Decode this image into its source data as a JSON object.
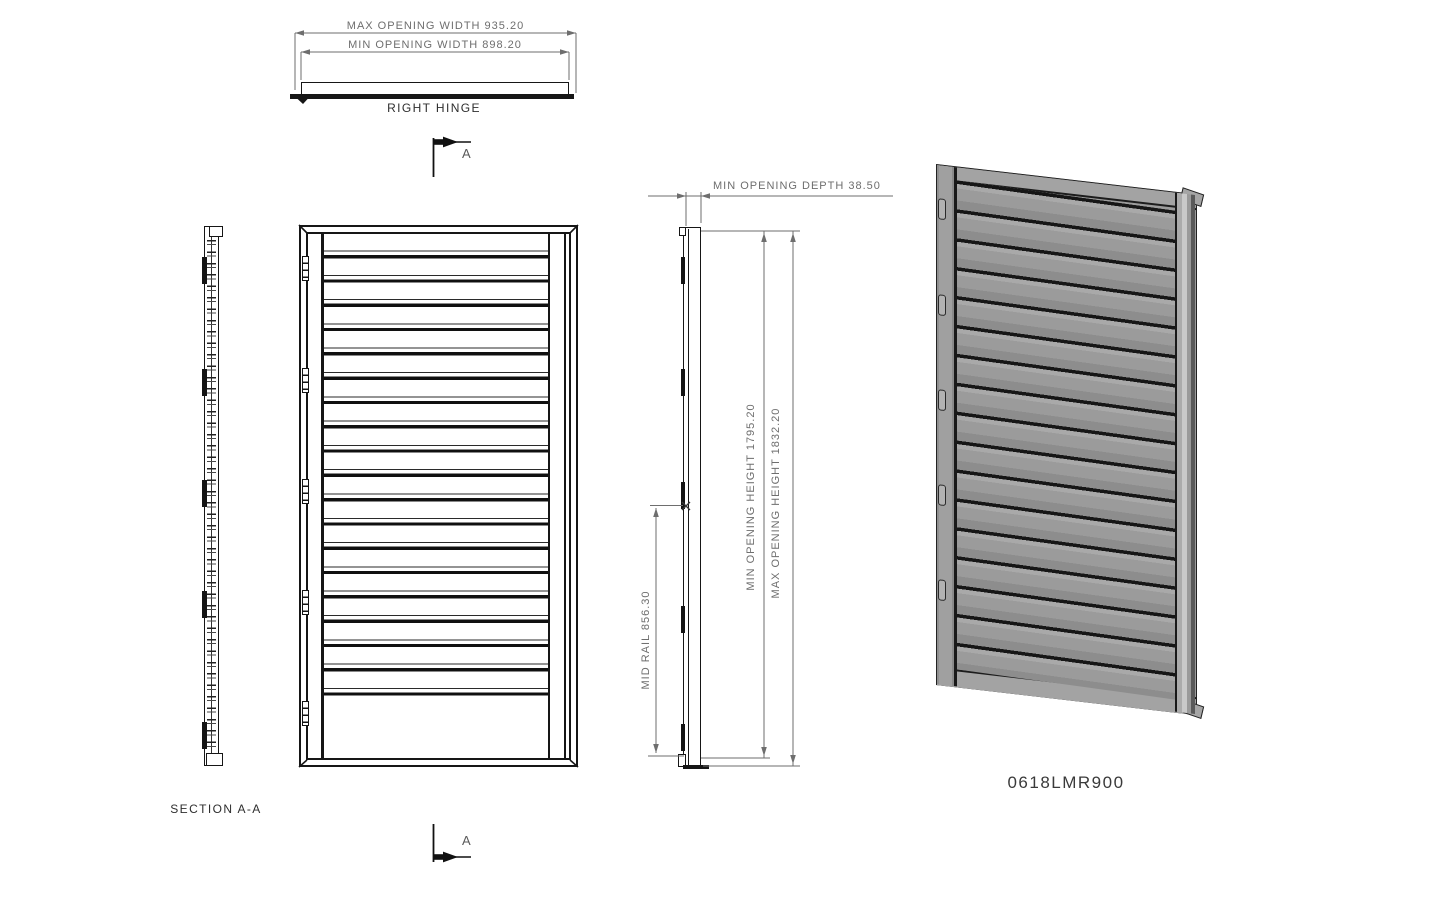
{
  "views": {
    "top": {
      "dim_max_width": "MAX OPENING WIDTH 935.20",
      "dim_min_width": "MIN OPENING WIDTH 898.20",
      "label": "RIGHT HINGE"
    },
    "section_cut": {
      "marker_top": "A",
      "marker_bottom": "A"
    },
    "section": {
      "label": "SECTION A-A",
      "hinge_count": 5
    },
    "front": {
      "louver_count": 19,
      "hinge_count": 5
    },
    "side": {
      "dim_depth": "MIN OPENING DEPTH 38.50",
      "dim_min_height": "MIN OPENING HEIGHT 1795.20",
      "dim_max_height": "MAX OPENING HEIGHT 1832.20",
      "dim_mid_rail": "MID RAIL 856.30",
      "hinge_count": 5
    },
    "iso": {
      "part_number": "0618LMR900",
      "louver_count": 17,
      "hinge_count": 5
    }
  },
  "colors": {
    "background": "#ffffff",
    "drawing_line": "#161616",
    "dimension_line": "#6e6e6e",
    "iso_fill": "#9c9c9c",
    "iso_louver_line": "#161616"
  }
}
